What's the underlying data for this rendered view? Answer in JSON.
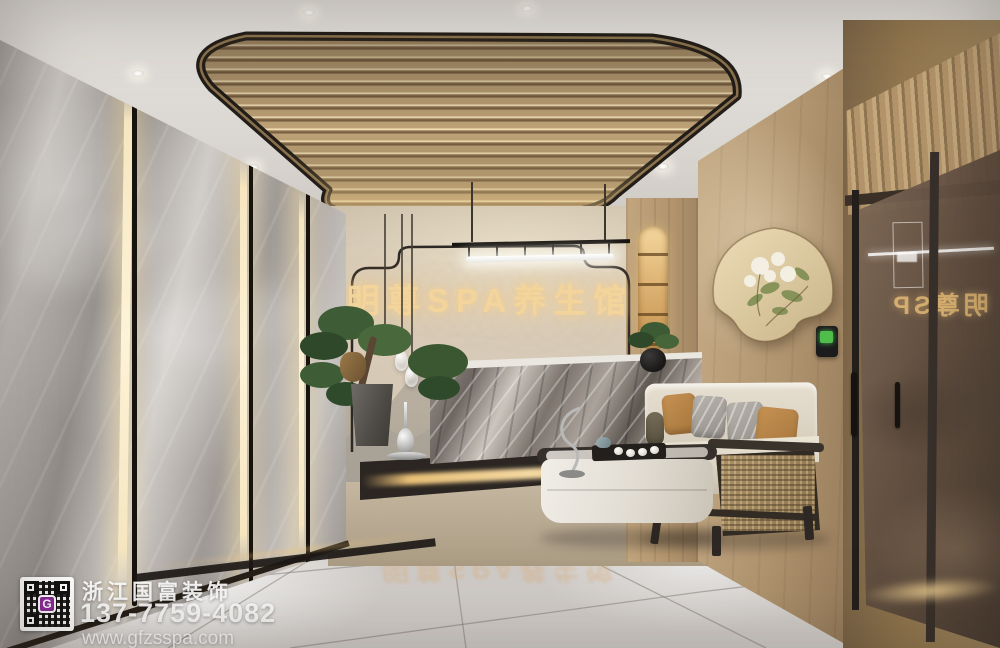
{
  "scene": {
    "signage": {
      "text": "明尊SPA养生馆"
    },
    "door_reflection": {
      "text": "明尊SP"
    },
    "floor_reflection": {
      "text": "明尊SPA养生馆"
    },
    "watermark": {
      "company": "浙江国富装饰",
      "phone": "137-7759-4082",
      "website": "www.gfzsspa.com",
      "logo_letter": "G"
    },
    "palette": {
      "gold_signage": "#f3d49a",
      "ceiling_wood": "#c0a478",
      "warm_glow": "#f5d9a0",
      "marble_wall_grey": "#b3aeaa",
      "desk_marble_grey": "#7a736c",
      "floor_grey": "#cdc9c5",
      "wood_wall": "#b49a78",
      "trim_black": "#26211d",
      "qr_logo_purple": "#8d2b9a",
      "device_screen_green": "#4fbd4a"
    }
  }
}
